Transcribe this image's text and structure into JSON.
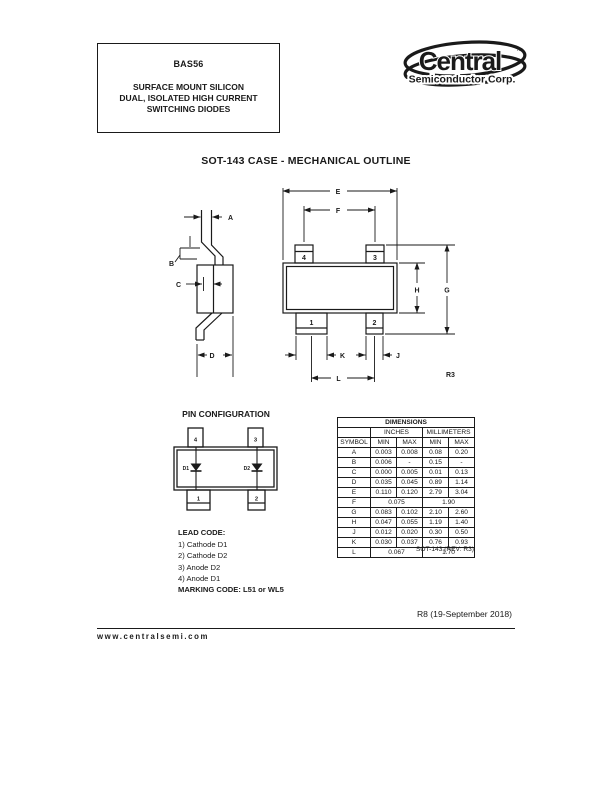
{
  "header": {
    "part_number": "BAS56",
    "description_lines": [
      "SURFACE MOUNT SILICON",
      "DUAL, ISOLATED HIGH CURRENT",
      "SWITCHING DIODES"
    ]
  },
  "logo": {
    "brand": "Central",
    "trademark": "™",
    "subtitle": "Semiconductor Corp."
  },
  "section": {
    "title": "SOT-143 CASE - MECHANICAL OUTLINE"
  },
  "outline": {
    "labels": {
      "a": "A",
      "b": "B",
      "c": "C",
      "d": "D",
      "e": "E",
      "f": "F",
      "g": "G",
      "h": "H",
      "j": "J",
      "k": "K",
      "l": "L"
    },
    "pins": {
      "p1": "1",
      "p2": "2",
      "p3": "3",
      "p4": "4"
    },
    "revision": "R3"
  },
  "pin_config": {
    "title": "PIN CONFIGURATION",
    "pins": {
      "p1": "1",
      "p2": "2",
      "p3": "3",
      "p4": "4"
    },
    "diodes": {
      "d1": "D1",
      "d2": "D2"
    }
  },
  "dimensions_table": {
    "title": "DIMENSIONS",
    "unit_headers": [
      "INCHES",
      "MILLIMETERS"
    ],
    "col_headers": [
      "SYMBOL",
      "MIN",
      "MAX",
      "MIN",
      "MAX"
    ],
    "rows": [
      {
        "symbol": "A",
        "in_min": "0.003",
        "in_max": "0.008",
        "mm_min": "0.08",
        "mm_max": "0.20"
      },
      {
        "symbol": "B",
        "in_min": "0.006",
        "in_max": "-",
        "mm_min": "0.15",
        "mm_max": "-"
      },
      {
        "symbol": "C",
        "in_min": "0.000",
        "in_max": "0.005",
        "mm_min": "0.01",
        "mm_max": "0.13"
      },
      {
        "symbol": "D",
        "in_min": "0.035",
        "in_max": "0.045",
        "mm_min": "0.89",
        "mm_max": "1.14"
      },
      {
        "symbol": "E",
        "in_min": "0.110",
        "in_max": "0.120",
        "mm_min": "2.79",
        "mm_max": "3.04"
      },
      {
        "symbol": "F",
        "in_span": "0.075",
        "mm_span": "1.90"
      },
      {
        "symbol": "G",
        "in_min": "0.083",
        "in_max": "0.102",
        "mm_min": "2.10",
        "mm_max": "2.60"
      },
      {
        "symbol": "H",
        "in_min": "0.047",
        "in_max": "0.055",
        "mm_min": "1.19",
        "mm_max": "1.40"
      },
      {
        "symbol": "J",
        "in_min": "0.012",
        "in_max": "0.020",
        "mm_min": "0.30",
        "mm_max": "0.50"
      },
      {
        "symbol": "K",
        "in_min": "0.030",
        "in_max": "0.037",
        "mm_min": "0.76",
        "mm_max": "0.93"
      },
      {
        "symbol": "L",
        "in_span": "0.067",
        "mm_span": "1.70"
      }
    ],
    "footnote": "SOT-143 (REV: R3)"
  },
  "lead_code": {
    "title": "LEAD CODE:",
    "items": [
      "1) Cathode D1",
      "2) Cathode D2",
      "3) Anode D2",
      "4) Anode D1"
    ]
  },
  "marking_code": "MARKING CODE: L51 or WL5",
  "footer": {
    "revision": "R8 (19-September 2018)",
    "website": "www.centralsemi.com"
  }
}
